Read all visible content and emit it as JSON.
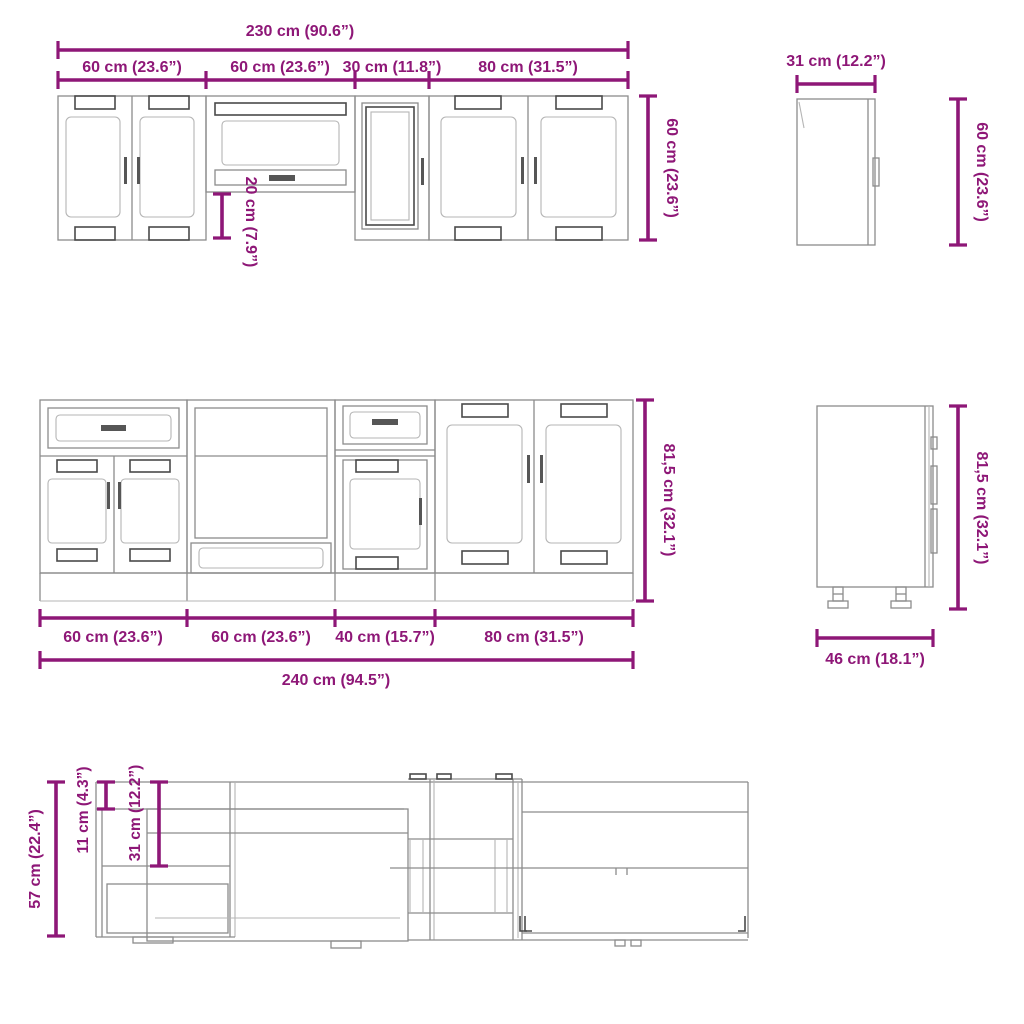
{
  "colors": {
    "dimension": "#8e1777",
    "drawing": "#8c8c8c",
    "drawing_dark": "#4a4a4a",
    "drawing_light": "#b5b5b5",
    "background": "#ffffff"
  },
  "wall_front": {
    "total": "230 cm (90.6”)",
    "segments": [
      "60 cm (23.6”)",
      "60 cm (23.6”)",
      "30 cm (11.8”)",
      "80 cm (31.5”)"
    ],
    "height": "60 cm (23.6”)",
    "gap": "20 cm (7.9”)"
  },
  "wall_side": {
    "depth": "31 cm (12.2”)",
    "height": "60 cm (23.6”)"
  },
  "base_front": {
    "segments": [
      "60 cm (23.6”)",
      "60 cm (23.6”)",
      "40 cm (15.7”)",
      "80 cm (31.5”)"
    ],
    "total": "240 cm (94.5”)",
    "height": "81,5 cm (32.1”)"
  },
  "base_side": {
    "depth": "46 cm (18.1”)",
    "height": "81,5 cm (32.1”)"
  },
  "top_view": {
    "overall_depth": "57 cm (22.4”)",
    "door_depth": "11 cm (4.3”)",
    "carcass_depth": "31 cm (12.2”)"
  }
}
